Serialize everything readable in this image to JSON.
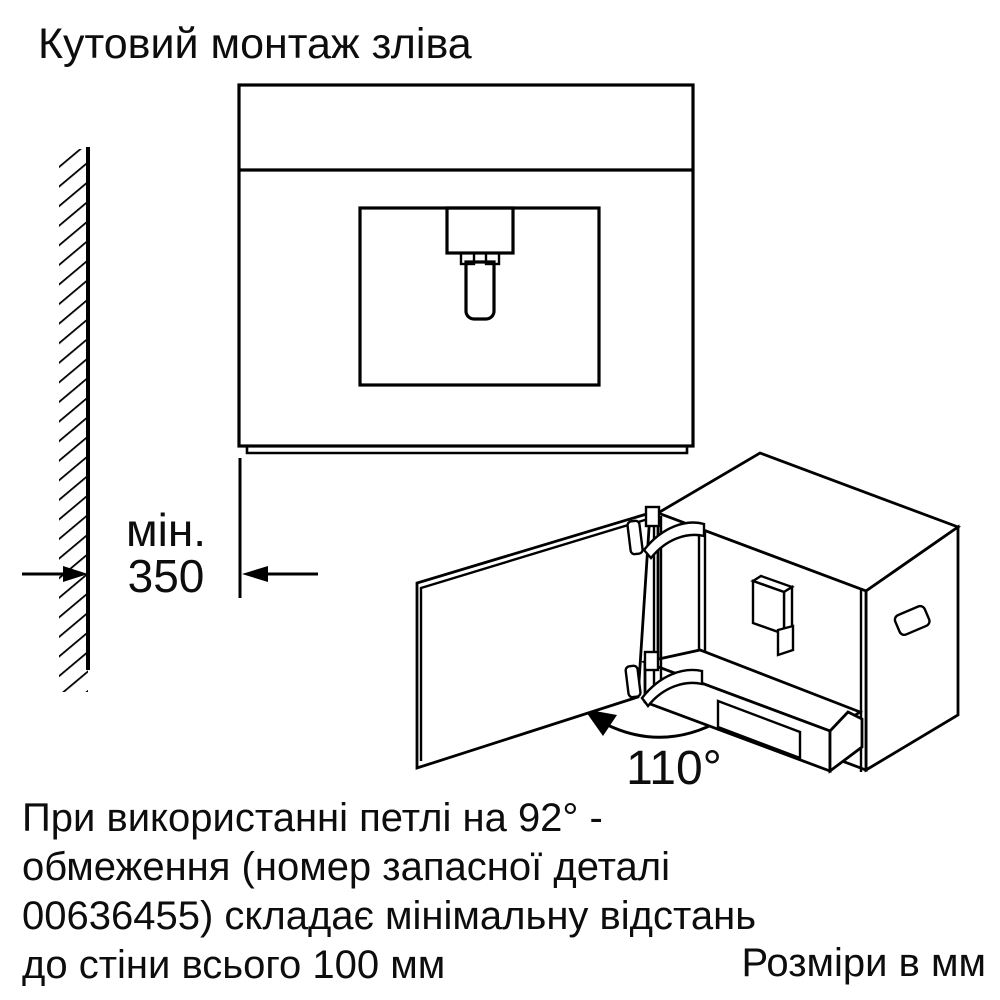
{
  "title": "Кутовий монтаж зліва",
  "wall_dimension": {
    "prefix": "мін.",
    "value": "350"
  },
  "door_angle": {
    "label": "110°"
  },
  "footer": {
    "note_lines": [
      "При використанні петлі на 92° -",
      "обмеження (номер запасної деталі",
      "00636455) складає мінімальну відстань",
      "до стіни всього 100 мм"
    ],
    "units_label": "Розміри в мм"
  },
  "colors": {
    "line": "#000000",
    "text": "#0d0d0d",
    "background": "#ffffff"
  }
}
